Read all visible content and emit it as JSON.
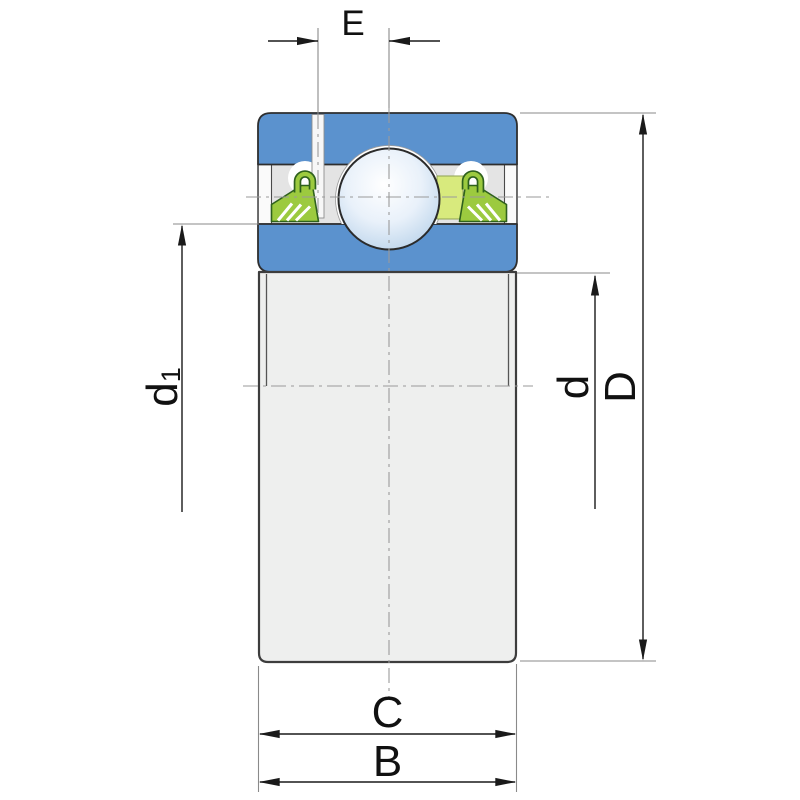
{
  "drawing": {
    "title": "Insert ball bearing cross-section technical drawing",
    "labels": {
      "E": "E",
      "C": "C",
      "B": "B",
      "D": "D",
      "d": "d",
      "d1_base": "d",
      "d1_sub": "1"
    },
    "colors": {
      "ring_blue": "#5b92ce",
      "seal_green": "#9cca3f",
      "seal_outline": "#2f611d",
      "cage_yellow_green": "#d8ea7d",
      "body_gray": "#eeefee",
      "strip_gray": "#e4e4e4",
      "pocket_white": "#ffffff",
      "dim_line_dark": "#1a1a1a",
      "aux_line_gray": "#8a8a8a"
    }
  }
}
